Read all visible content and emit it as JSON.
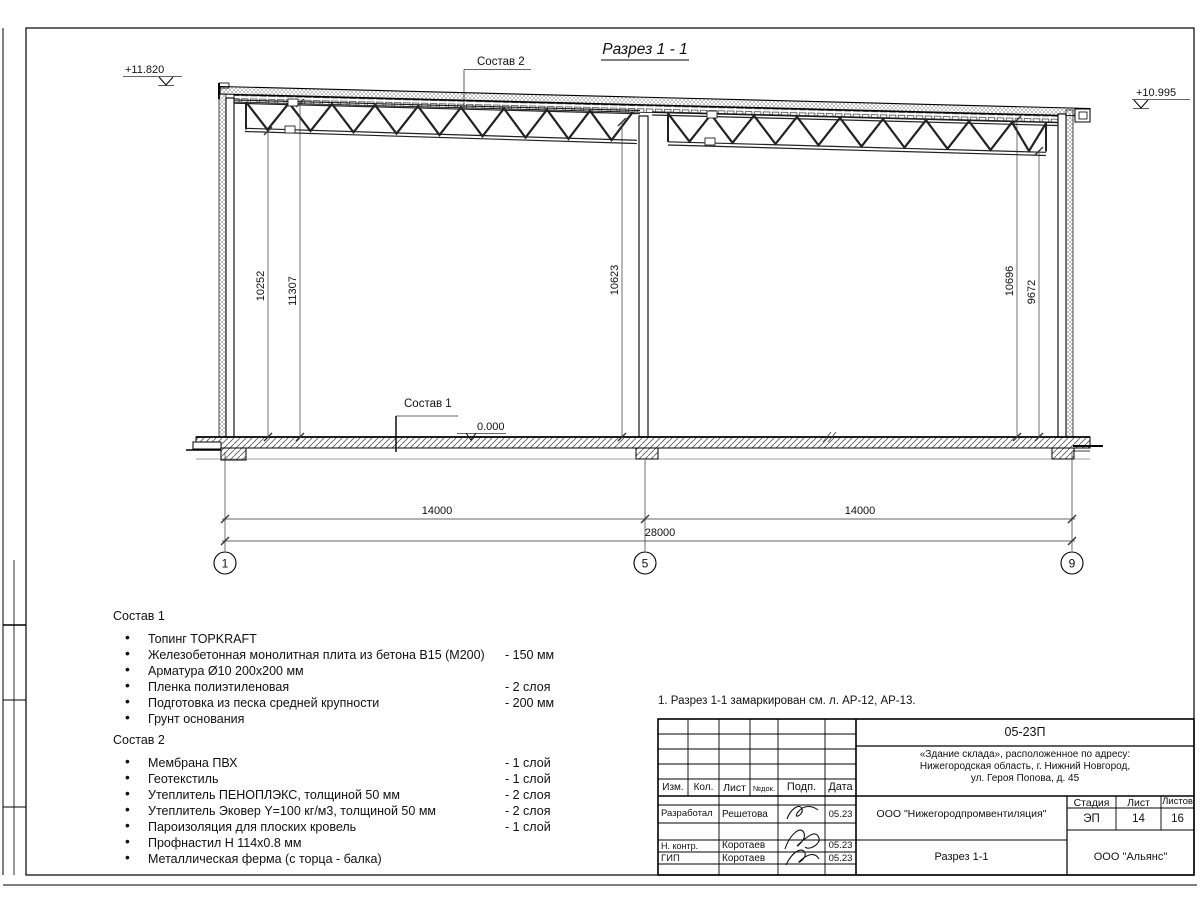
{
  "bullet_char": "•",
  "drawing": {
    "title": "Разрез 1 - 1",
    "elev_left": "+11.820",
    "elev_right": "+10.995",
    "elev_zero": "0.000",
    "callout_sostav1": "Состав 1",
    "callout_sostav2": "Состав 2",
    "dim_left_inner": "10252",
    "dim_left_outer": "11307",
    "dim_mid": "10623",
    "dim_right_outer": "10696",
    "dim_right_inner": "9672",
    "dim_bay_left": "14000",
    "dim_bay_right": "14000",
    "dim_total": "28000",
    "axis_1": "1",
    "axis_5": "5",
    "axis_9": "9"
  },
  "composition1": {
    "title": "Состав 1",
    "items": [
      {
        "name": "Топинг TOPKRAFT",
        "qty": ""
      },
      {
        "name": "Железобетонная монолитная плита из бетона В15 (М200)",
        "qty": "-  150 мм"
      },
      {
        "name": "Арматура Ø10 200х200 мм",
        "qty": ""
      },
      {
        "name": "Пленка полиэтиленовая",
        "qty": "-  2 слоя"
      },
      {
        "name": "Подготовка из песка средней крупности",
        "qty": "- 200 мм"
      },
      {
        "name": "Грунт основания",
        "qty": ""
      }
    ]
  },
  "composition2": {
    "title": "Состав 2",
    "items": [
      {
        "name": "Мембрана ПВХ",
        "qty": "- 1 слой"
      },
      {
        "name": "Геотекстиль",
        "qty": "- 1 слой"
      },
      {
        "name": "Утеплитель ПЕНОПЛЭКС, толщиной 50 мм",
        "qty": "- 2 слоя"
      },
      {
        "name": "Утеплитель Эковер Y=100 кг/м3, толщиной 50 мм",
        "qty": "- 2 слоя"
      },
      {
        "name": "Пароизоляция для плоских кровель",
        "qty": "- 1 слой"
      },
      {
        "name": "Профнастил Н 114х0.8 мм",
        "qty": ""
      },
      {
        "name": "Металлическая ферма (с торца - балка)",
        "qty": ""
      }
    ]
  },
  "note": "1. Разрез 1-1 замаркирован см. л. АР-12, АР-13.",
  "stamp": {
    "doc_number": "05-23П",
    "object_address": [
      "«Здание склада», расположенное по адресу:",
      "Нижегородская область, г. Нижний Новгород,",
      "ул. Героя Попова, д. 45"
    ],
    "cols": {
      "izm": "Изм.",
      "kol": "Кол.",
      "list": "Лист",
      "ndok": "№док.",
      "podp": "Подп.",
      "data": "Дата"
    },
    "rows": [
      {
        "role": "Разработал",
        "name": "Решетова",
        "date": "05.23"
      },
      {
        "role": "Н. контр.",
        "name": "Коротаев",
        "date": "05.23"
      },
      {
        "role": "ГИП",
        "name": "Коротаев",
        "date": "05.23"
      }
    ],
    "org": "ООО \"Нижегородпромвентиляция\"",
    "stage_label": "Стадия",
    "sheet_label": "Лист",
    "sheets_label": "Листов",
    "stage": "ЭП",
    "sheet": "14",
    "sheets": "16",
    "drawing_name": "Разрез 1-1",
    "org2": "ООО \"Альянс\""
  }
}
